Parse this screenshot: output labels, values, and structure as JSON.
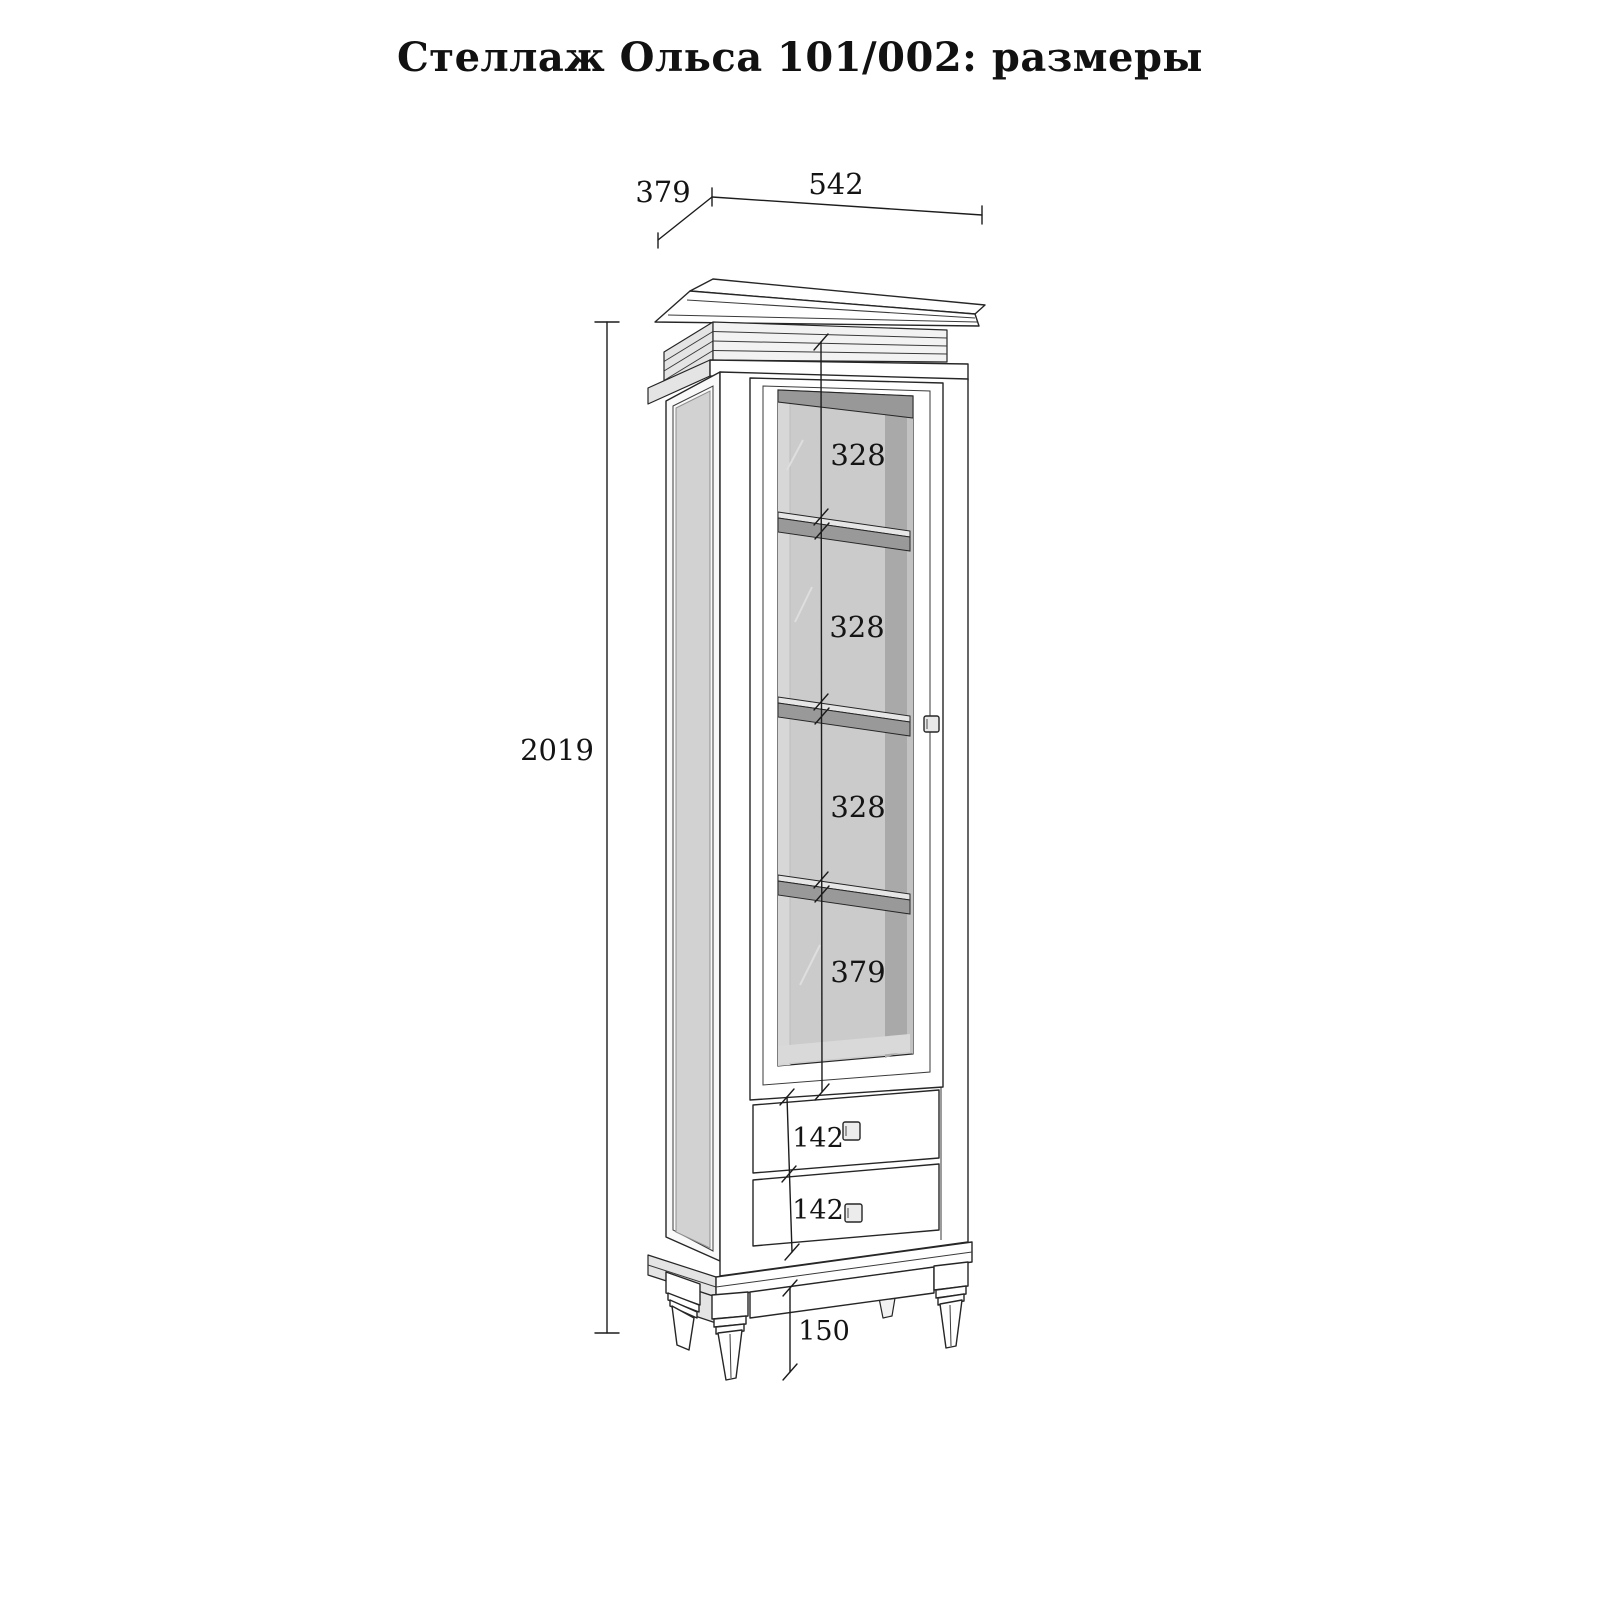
{
  "title": "Стеллаж Ольса 101/002: размеры",
  "dimensions": {
    "width": "542",
    "depth": "379",
    "height": "2019",
    "compartments": [
      "328",
      "328",
      "328",
      "379"
    ],
    "drawers": [
      "142",
      "142"
    ],
    "legs": "150"
  },
  "colors": {
    "line": "#262626",
    "interior_back": "#cbcbcb",
    "interior_shadow": "#989898",
    "interior_side": "#a9a9a9",
    "shelf_front": "#999999",
    "side_panel": "#d2d2d2",
    "background": "#ffffff"
  }
}
